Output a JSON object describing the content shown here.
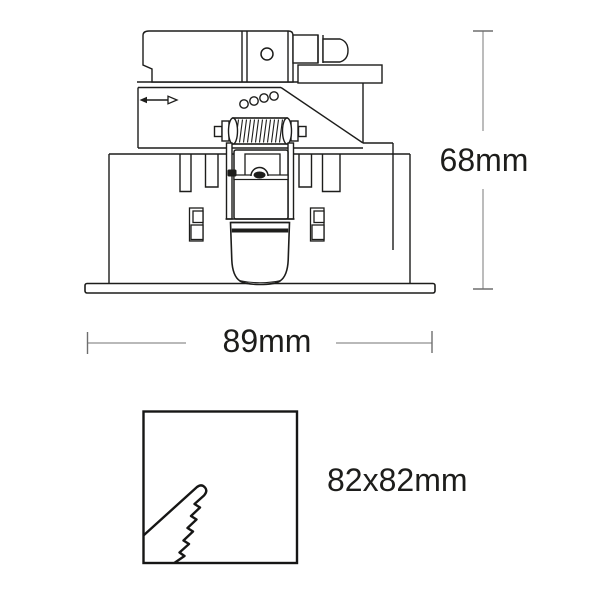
{
  "colors": {
    "background": "#ffffff",
    "drawing_line": "#1d1d1b",
    "dimension_line": "#8f8f8f",
    "dimension_tick": "#6e6e6e",
    "label_text": "#1d1d1b"
  },
  "diagram": {
    "kind": "product-dimension-drawing",
    "subject": "recessed-downlight-side-view",
    "icons": {
      "adjustment_arrow": "double-headed-horizontal-arrow",
      "saw_cut": "zigzag-cutout-wedge",
      "terminal_screw": "circle-screw-head"
    }
  },
  "dimensions": {
    "height": {
      "label": "68mm"
    },
    "width": {
      "label": "89mm"
    },
    "cutout": {
      "label": "82x82mm"
    }
  }
}
